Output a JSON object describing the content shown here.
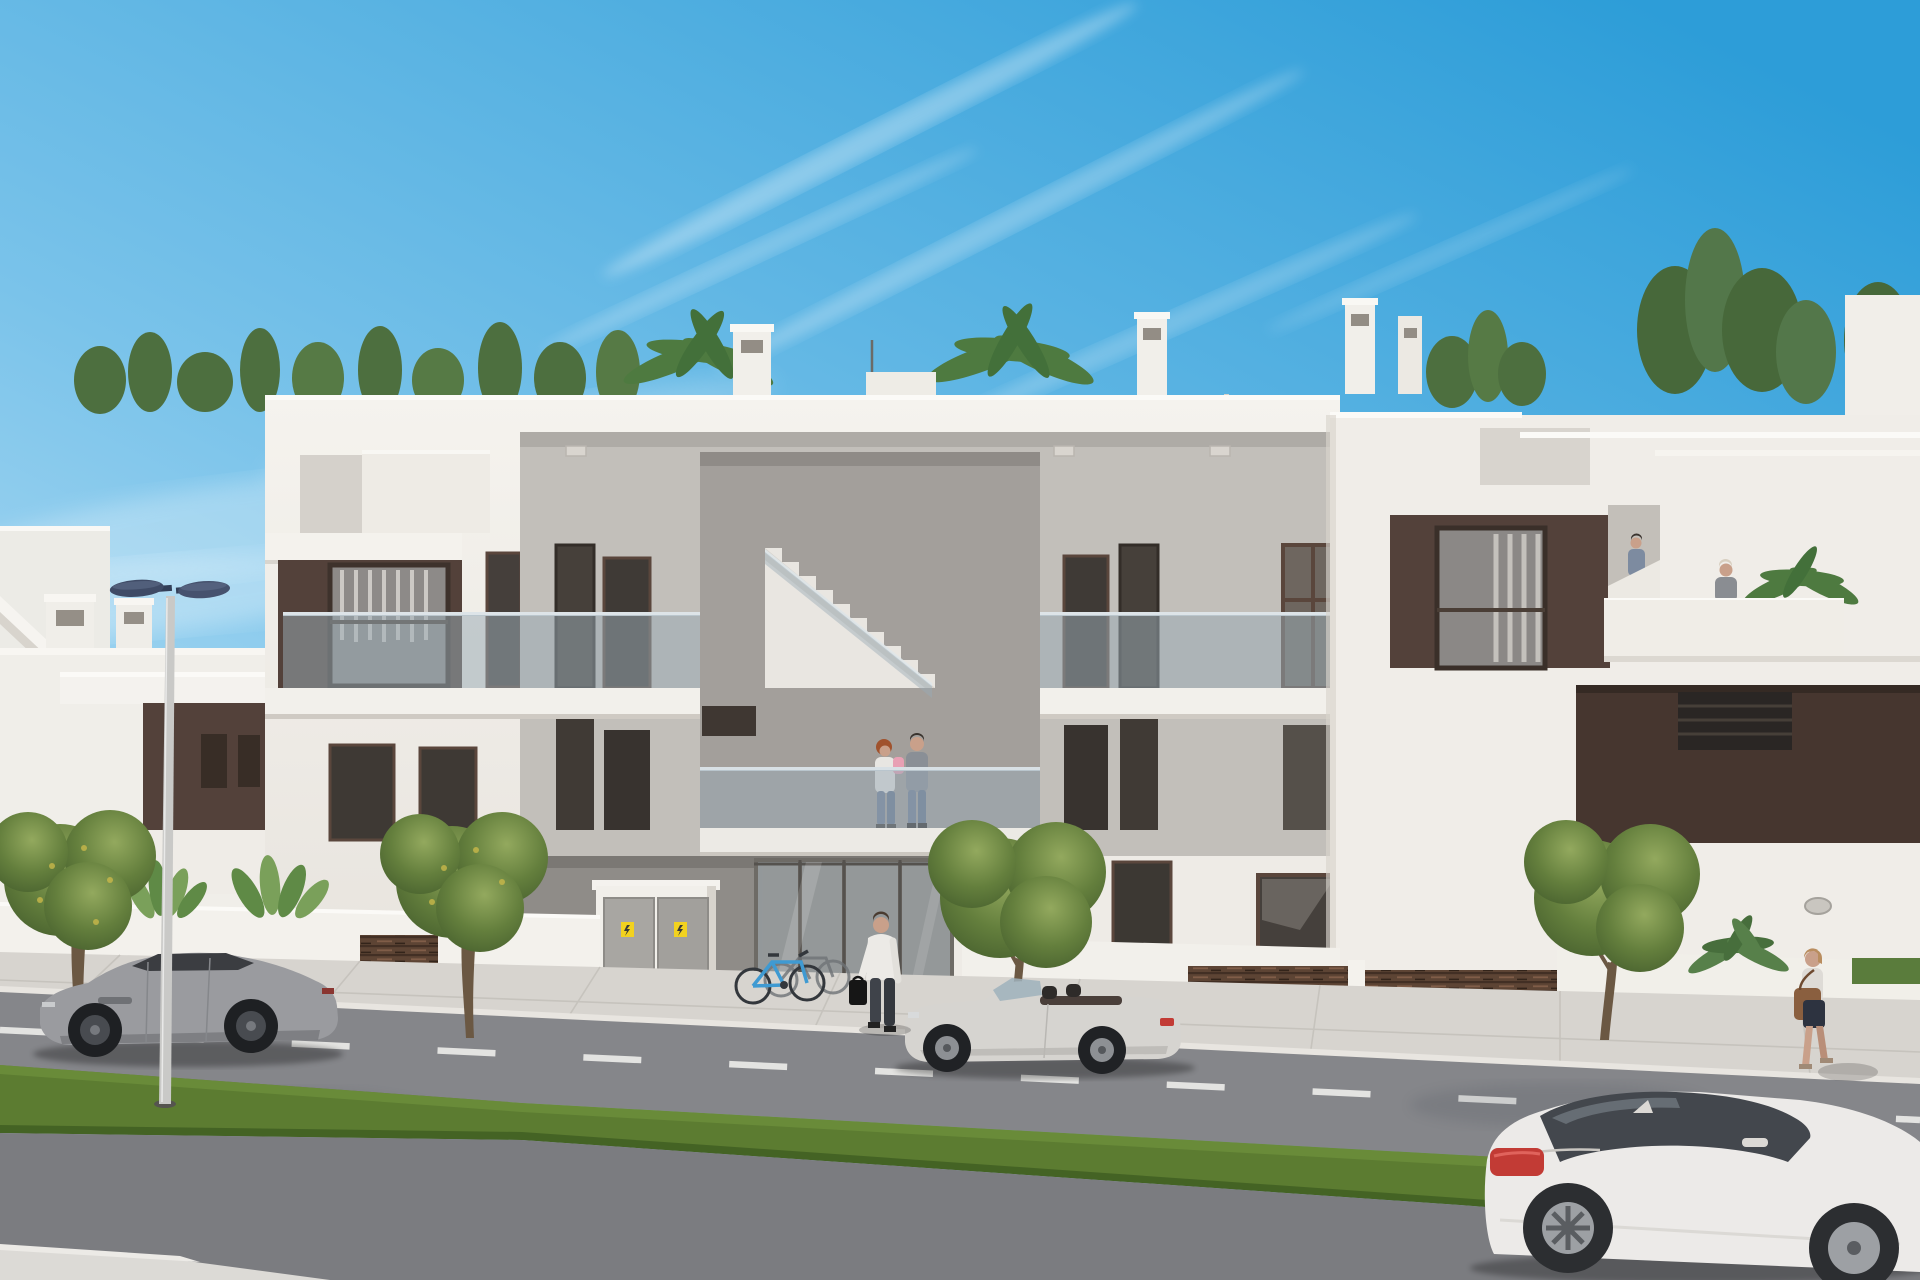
{
  "meta": {
    "title": "New-build apartment complex - street view architectural rendering",
    "type": "3D exterior visualization",
    "description": "Two-storey modern white apartment block with brown accent panels, glass balcony balustrades, central open staircase, rooftop solarium with plants and parasol, street in front with parked cars, grass median and pedestrians under a clear blue sky"
  },
  "palette": {
    "sky_top": "#2d9dd8",
    "sky_mid": "#7ac3ea",
    "sky_horizon": "#cfeaf8",
    "cloud": "#ffffff",
    "facade_white": "#f0ede8",
    "facade_shade": "#dcd8d1",
    "recess_gray": "#c2bfba",
    "porch_gray": "#8f8c88",
    "void_gray": "#a39f9b",
    "accent_brown": "#53413a",
    "accent_brown_dark": "#46362f",
    "window_dark": "#433d38",
    "window_frame": "#5a463c",
    "glass_rail": "#9aaab5",
    "glass_entry": "#b3bec4",
    "stair_white": "#e9e6e1",
    "roof_green": "#4d6f3f",
    "palm_green": "#4e7a40",
    "tree_trunk": "#6b5843",
    "grass": "#5c7c31",
    "sidewalk": "#d7d4cf",
    "curb": "#e8e5e0",
    "road": "#85868a",
    "road_near": "#7b7c80",
    "lane_line": "#e8e8e6",
    "lamp_head": "#3f4b66",
    "lamp_pole": "#c9c9c7",
    "fence_brown": "#5d4434",
    "cabinet_gray": "#a8a6a2",
    "sticker_yellow": "#f2d21f",
    "bike_blue": "#3f9ad2",
    "car_gray": "#9a9b9f",
    "car_silver": "#d6d4d0",
    "car_white": "#eceae8",
    "taillight_red": "#c23b35",
    "skin": "#c9a08a",
    "jeans": "#6e7d94",
    "shirt_white": "#eceae6",
    "tee_gray": "#8a8f96",
    "baby_pink": "#e8a0b4",
    "bag_brown": "#8a5f3f",
    "shadow": "#2e3744"
  },
  "scene": {
    "sky": {
      "label": "clear blue sky with thin cirrus cloud streaks"
    },
    "building": {
      "label": "modern two-storey white apartment building with brown accent panels",
      "features_roof": "rooftop solarium with shrubs, palm trees, white parasol and chimneys",
      "features_first_floor": "glass balustrade walkway, brown framed windows, central open staircase",
      "features_ground_floor": "glazed entrance lobby, utility cabinets, brown slatted fences, private terraces"
    },
    "background": {
      "label": "neighbouring white buildings with exterior stair and chimneys"
    },
    "people": {
      "balcony_family": "woman holding baby and man standing on first floor walkway",
      "entrance_man": "man in white shirt with black briefcase at the entrance",
      "stair_man": "man climbing the side staircase",
      "terrace_woman": "woman standing on the roof terrace",
      "walking_woman": "woman walking on the sidewalk carrying a brown shoulder bag"
    },
    "vehicles": {
      "gray_coupe": "gray sports coupe parked on the left",
      "silver_convertible": "silver open-top roadster parked by the entrance",
      "white_coupe": "white coupe in the foreground lane on the right"
    },
    "street": {
      "label": "asphalt road with dashed lane marking, paved sidewalk, grass median strip and white curb"
    },
    "vegetation": {
      "label": "street trees with yellow blossom, banana plants behind low walls, rooftop shrubs and palms"
    },
    "objects": {
      "street_lamp": "double-head street lamp with dark blue luminaires",
      "bikes": "blue bicycle and second bicycle parked at the entrance",
      "cabinets": "gray utility cabinet doors with yellow warning stickers",
      "parasol": "white parasol on the roof terrace",
      "wall_lamp": "oval wall lamp on the right wall"
    }
  }
}
